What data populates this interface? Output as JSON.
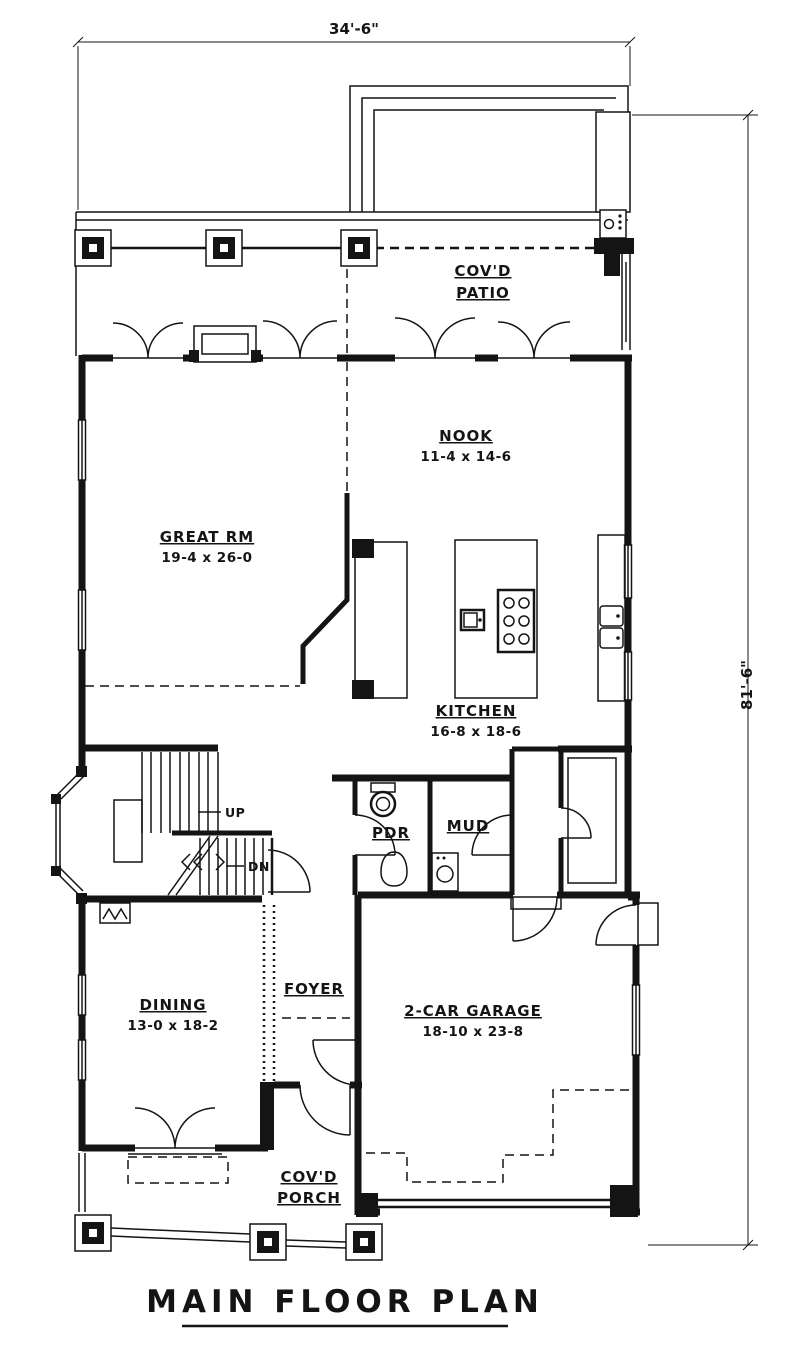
{
  "title": "MAIN FLOOR PLAN",
  "colors": {
    "line": "#141414",
    "background": "#ffffff"
  },
  "dimensions": {
    "width": "34'-6\"",
    "height": "81'-6\""
  },
  "rooms": {
    "patio": {
      "line1": "COV'D",
      "line2": "PATIO"
    },
    "nook": {
      "name": "NOOK",
      "size": "11-4 x 14-6"
    },
    "great_rm": {
      "name": "GREAT RM",
      "size": "19-4 x 26-0"
    },
    "kitchen": {
      "name": "KITCHEN",
      "size": "16-8 x 18-6"
    },
    "pdr": {
      "name": "PDR"
    },
    "mud": {
      "name": "MUD"
    },
    "dining": {
      "name": "DINING",
      "size": "13-0 x 18-2"
    },
    "foyer": {
      "name": "FOYER"
    },
    "garage": {
      "name": "2-CAR GARAGE",
      "size": "18-10 x 23-8"
    },
    "porch": {
      "line1": "COV'D",
      "line2": "PORCH"
    }
  },
  "stairs": {
    "up": "UP",
    "dn": "DN"
  }
}
